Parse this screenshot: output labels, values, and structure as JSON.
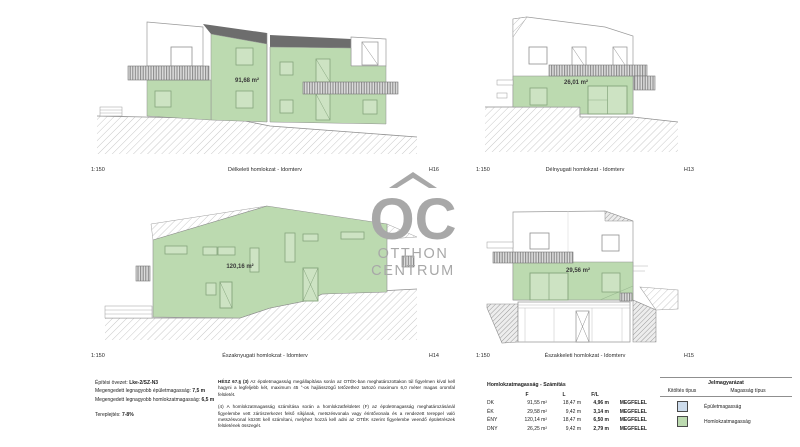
{
  "drawings": [
    {
      "scale": "1:150",
      "title": "Délkeleti homlokzat - Idomterv",
      "code": "H16",
      "area_label": "91,68 m²"
    },
    {
      "scale": "1:150",
      "title": "Délnyugati homlokzat - Idomterv",
      "code": "H13",
      "area_label": "26,01 m²"
    },
    {
      "scale": "1:150",
      "title": "Északnyugati homlokzat - Idomterv",
      "code": "H14",
      "area_label": "120,16 m²"
    },
    {
      "scale": "1:150",
      "title": "Északkeleti homlokzat - Idomterv",
      "code": "H15",
      "area_label": "29,56 m²"
    }
  ],
  "watermark": {
    "monogram": "OC",
    "line1": "OTTHON",
    "line2": "CENTRUM",
    "color": "#a8a8a8"
  },
  "zone_info": {
    "zone_label": "Építési övezet: ",
    "zone_value": "Lke-2/SZ-N3",
    "building_label": "Megengedett legnagyobb épületmagasság: ",
    "building_value": "7,5 m",
    "facade_label": "Megengedett legnagyobb homlokzatmagasság: ",
    "facade_value": "6,5 m",
    "slope_label": "Tereplejtés: ",
    "slope_value": "7-8%"
  },
  "regulation": {
    "p1_bold": "HÉSZ 67.§ (3)",
    "p1_rest": " Az épületmagasság megállapítása során az OTÉK-ban meghatározottakon túl figyelmen kívül kell hagyni a legfeljebb két, maximum 45 °-os hajlásszögű tetőzethez tartozó maximum 6,0 méter magas oromfal felületét.",
    "p2": "(4) A homlokzatmagasság számítása során a homlokzatfelületet (F) az épületmagasság meghatározásánál figyelembe vett zárószerkezet felső síkjának, metszésvonala vagy érintővonala és a rendezett tereppel való metszésvonal között kell számítani, melyhez hozzá kell adni az OTÉK szerint figyelembe veendő épületrészek felületének összegét."
  },
  "calculation": {
    "title": "Homlokzatmagasság - Számítás",
    "headers": {
      "f": "F",
      "l": "L",
      "fl": "F/L"
    },
    "rows": [
      {
        "dir": "DK",
        "f": "91,55 m²",
        "l": "18,47 m",
        "fl": "4,96 m",
        "result": "MEGFELEL"
      },
      {
        "dir": "ÉK",
        "f": "29,58 m²",
        "l": "9,42 m",
        "fl": "3,14 m",
        "result": "MEGFELEL"
      },
      {
        "dir": "ÉNY",
        "f": "120,14 m²",
        "l": "18,47 m",
        "fl": "6,50 m",
        "result": "MEGFELEL"
      },
      {
        "dir": "DNY",
        "f": "26,25 m²",
        "l": "9,42 m",
        "fl": "2,79 m",
        "result": "MEGFELEL"
      }
    ]
  },
  "legend": {
    "title": "Jelmagyarázat",
    "col_fill": "Kitöltés típus",
    "col_height": "Magasság típus",
    "items": [
      {
        "label": "Épületmagasság",
        "color": "#cddcec"
      },
      {
        "label": "Homlokzatmagasság",
        "color": "#bcdab0"
      }
    ]
  },
  "colors": {
    "facade_highlight": "#bcdab0",
    "roof_dark": "#6d6d6d",
    "outline": "#9a9a9a",
    "watermark": "#a8a8a8"
  }
}
